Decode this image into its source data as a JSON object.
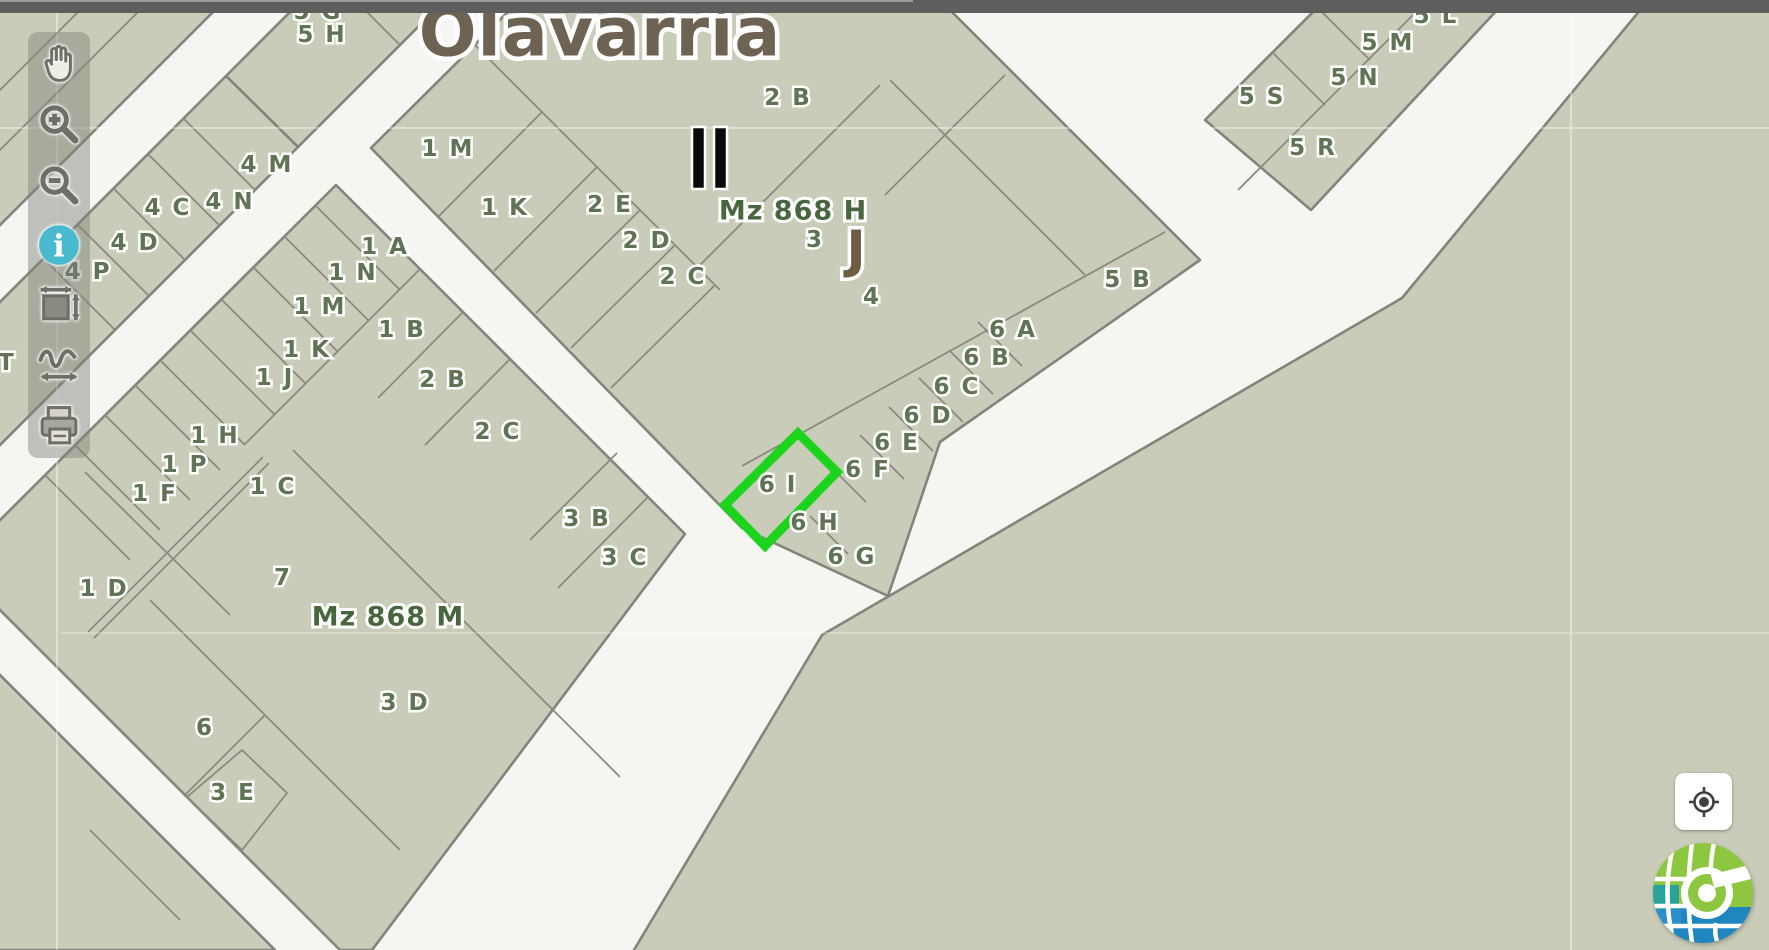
{
  "window": {
    "top_bar": {
      "color": "#5e5e5e",
      "shine_color": "#9b9b9b",
      "shine_width_px": 913
    }
  },
  "map": {
    "city_label": {
      "text": "Olavarría",
      "x": 600,
      "y": 33
    },
    "district_labels": [
      {
        "text": "Mz 868 H",
        "x": 793,
        "y": 211
      },
      {
        "text": "Mz 868 M",
        "x": 388,
        "y": 617
      }
    ],
    "zone_letter": {
      "text": "J",
      "x": 856,
      "y": 250
    },
    "monument_bars": {
      "x": 692,
      "y": 127,
      "bar_width": 13,
      "bar_height": 62,
      "gap": 9
    },
    "parcel_labels": [
      {
        "text": "5 H",
        "x": 322,
        "y": 35
      },
      {
        "text": "4 M",
        "x": 267,
        "y": 165
      },
      {
        "text": "4 N",
        "x": 230,
        "y": 202
      },
      {
        "text": "4 C",
        "x": 168,
        "y": 208
      },
      {
        "text": "4 D",
        "x": 135,
        "y": 243
      },
      {
        "text": "4 P",
        "x": 88,
        "y": 272
      },
      {
        "text": "1 A",
        "x": 385,
        "y": 247
      },
      {
        "text": "1 N",
        "x": 353,
        "y": 273
      },
      {
        "text": "1 M",
        "x": 320,
        "y": 307
      },
      {
        "text": "1 B",
        "x": 402,
        "y": 330
      },
      {
        "text": "1 K",
        "x": 307,
        "y": 350
      },
      {
        "text": "1 J",
        "x": 275,
        "y": 378
      },
      {
        "text": "2 B",
        "x": 443,
        "y": 380
      },
      {
        "text": "2 C",
        "x": 498,
        "y": 432
      },
      {
        "text": "1 H",
        "x": 215,
        "y": 436
      },
      {
        "text": "1 P",
        "x": 185,
        "y": 465
      },
      {
        "text": "1 F",
        "x": 155,
        "y": 494
      },
      {
        "text": "1 C",
        "x": 273,
        "y": 487
      },
      {
        "text": "3 B",
        "x": 587,
        "y": 519
      },
      {
        "text": "3 C",
        "x": 625,
        "y": 558
      },
      {
        "text": "1 D",
        "x": 104,
        "y": 589
      },
      {
        "text": "7",
        "x": 283,
        "y": 578
      },
      {
        "text": "3 D",
        "x": 405,
        "y": 703
      },
      {
        "text": "6",
        "x": 205,
        "y": 728
      },
      {
        "text": "3 E",
        "x": 233,
        "y": 793
      },
      {
        "text": "1 M",
        "x": 448,
        "y": 149
      },
      {
        "text": "1 K",
        "x": 505,
        "y": 208
      },
      {
        "text": "2 E",
        "x": 610,
        "y": 205
      },
      {
        "text": "2 D",
        "x": 647,
        "y": 241
      },
      {
        "text": "2 C",
        "x": 683,
        "y": 277
      },
      {
        "text": "2 B",
        "x": 788,
        "y": 98
      },
      {
        "text": "3",
        "x": 815,
        "y": 240
      },
      {
        "text": "4",
        "x": 872,
        "y": 297
      },
      {
        "text": "5 B",
        "x": 1128,
        "y": 280
      },
      {
        "text": "6 A",
        "x": 1013,
        "y": 330
      },
      {
        "text": "6 B",
        "x": 987,
        "y": 358
      },
      {
        "text": "6 C",
        "x": 957,
        "y": 387
      },
      {
        "text": "6 D",
        "x": 928,
        "y": 416
      },
      {
        "text": "6 E",
        "x": 897,
        "y": 443
      },
      {
        "text": "6 F",
        "x": 868,
        "y": 470
      },
      {
        "text": "6 I",
        "x": 778,
        "y": 485
      },
      {
        "text": "6 H",
        "x": 815,
        "y": 523
      },
      {
        "text": "6 G",
        "x": 852,
        "y": 557
      },
      {
        "text": "5 S",
        "x": 1262,
        "y": 97
      },
      {
        "text": "5 N",
        "x": 1355,
        "y": 78
      },
      {
        "text": "5 M",
        "x": 1388,
        "y": 43
      },
      {
        "text": "5 R",
        "x": 1313,
        "y": 148
      }
    ],
    "clipped_labels": [
      {
        "text": "5 G",
        "x": 318,
        "y": 12
      },
      {
        "text": "5 L",
        "x": 1436,
        "y": 16
      },
      {
        "text": "T",
        "x": 7,
        "y": 363
      }
    ],
    "selected_parcel": {
      "label": "6 I",
      "outline_color": "#1bd41b",
      "points": "798,433 837,472 765,546 725,505"
    },
    "palette": {
      "parcel_fill": "#c9ccb8",
      "road": "#f5f5f2",
      "parcel_border": "#84847c",
      "label_green": "#5f7355",
      "district_green": "#47663d",
      "city_brown": "#6e6353",
      "letter_brown": "#6e5b41",
      "info_icon_blue": "#49b9ce"
    }
  },
  "toolbar": {
    "items": [
      {
        "id": "pan",
        "icon": "hand-icon"
      },
      {
        "id": "zoom-in",
        "icon": "zoom-in-icon"
      },
      {
        "id": "zoom-out",
        "icon": "zoom-out-icon"
      },
      {
        "id": "info",
        "icon": "info-icon"
      },
      {
        "id": "extent",
        "icon": "extent-icon"
      },
      {
        "id": "measure",
        "icon": "measure-icon"
      },
      {
        "id": "print",
        "icon": "print-icon"
      }
    ]
  },
  "controls": {
    "locate_button": {
      "icon": "locate-icon"
    },
    "logo": {
      "name": "geo-portal-logo"
    }
  }
}
